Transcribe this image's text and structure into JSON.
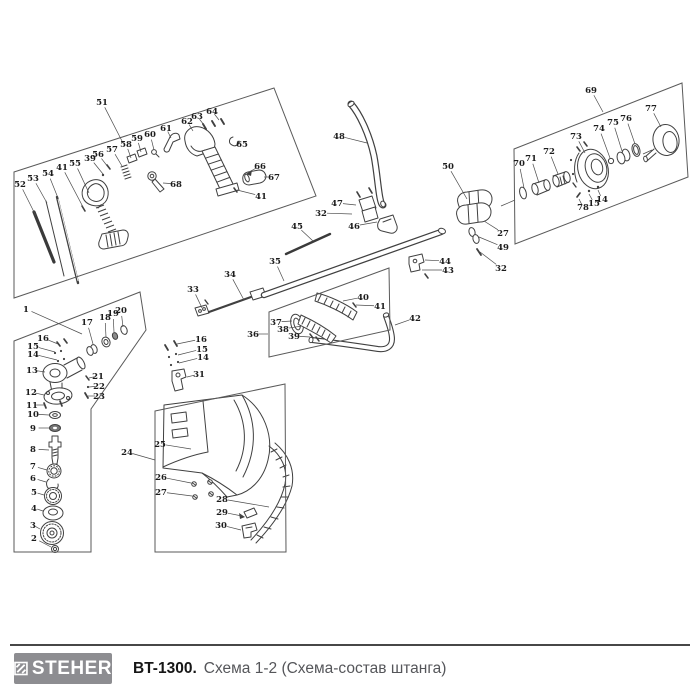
{
  "footer": {
    "brand": "STEHER",
    "model": "BT-1300.",
    "subtitle": "Схема 1-2 (Схема-состав штанга)",
    "logo_bg": "#8d8d91",
    "logo_text_color": "#ffffff",
    "model_color": "#161616",
    "subtitle_color": "#55565a",
    "rule_color": "#474747"
  },
  "diagram": {
    "stroke_color": "#404040",
    "label_color": "#1c1c1c",
    "leader_color": "#4c4c4c",
    "boxes": [
      {
        "name": "handle-trigger-assembly-box",
        "points": "14,172 274,88 316,196 14,298"
      },
      {
        "name": "starter-coupling-assembly-box",
        "points": "514,149 682,83 688,177 515,244"
      },
      {
        "name": "grip-assembly-box",
        "points": "269,312 389,268 390,330 269,357"
      },
      {
        "name": "guard-assembly-box",
        "points": "155,411 285,384 286,552 155,552"
      },
      {
        "name": "gearbox-assembly-box",
        "points": "14,341 140,292 146,330 91,409 91,552 14,552"
      }
    ],
    "labels": [
      {
        "n": "51",
        "x": 102,
        "y": 102,
        "tx": 123,
        "ty": 143
      },
      {
        "n": "52",
        "x": 20,
        "y": 184,
        "tx": 36,
        "ty": 216
      },
      {
        "n": "53",
        "x": 33,
        "y": 178,
        "tx": 47,
        "ty": 203
      },
      {
        "n": "54",
        "x": 48,
        "y": 173,
        "tx": 58,
        "ty": 198
      },
      {
        "n": "41",
        "x": 62,
        "y": 167,
        "tx": 83,
        "ty": 207
      },
      {
        "n": "55",
        "x": 75,
        "y": 163,
        "tx": 89,
        "ty": 193
      },
      {
        "n": "39",
        "x": 90,
        "y": 158,
        "tx": 103,
        "ty": 174
      },
      {
        "n": "56",
        "x": 98,
        "y": 154,
        "tx": 108,
        "ty": 167
      },
      {
        "n": "57",
        "x": 112,
        "y": 149,
        "tx": 122,
        "ty": 166
      },
      {
        "n": "58",
        "x": 126,
        "y": 144,
        "tx": 131,
        "ty": 158
      },
      {
        "n": "59",
        "x": 137,
        "y": 138,
        "tx": 141,
        "ty": 152
      },
      {
        "n": "60",
        "x": 150,
        "y": 134,
        "tx": 154,
        "ty": 150
      },
      {
        "n": "61",
        "x": 166,
        "y": 128,
        "tx": 171,
        "ty": 138
      },
      {
        "n": "62",
        "x": 187,
        "y": 121,
        "tx": 193,
        "ty": 131
      },
      {
        "n": "63",
        "x": 197,
        "y": 116,
        "tx": 204,
        "ty": 125
      },
      {
        "n": "64",
        "x": 212,
        "y": 111,
        "tx": 219,
        "ty": 120
      },
      {
        "n": "65",
        "x": 242,
        "y": 144,
        "tx": 237,
        "ty": 141
      },
      {
        "n": "66",
        "x": 260,
        "y": 166,
        "tx": 249,
        "ty": 172
      },
      {
        "n": "67",
        "x": 274,
        "y": 177,
        "tx": 264,
        "ty": 177
      },
      {
        "n": "41",
        "x": 261,
        "y": 196,
        "tx": 237,
        "ty": 190
      },
      {
        "n": "68",
        "x": 176,
        "y": 184,
        "tx": 163,
        "ty": 183
      },
      {
        "n": "48",
        "x": 339,
        "y": 136,
        "tx": 367,
        "ty": 143
      },
      {
        "n": "45",
        "x": 297,
        "y": 226,
        "tx": 313,
        "ty": 241
      },
      {
        "n": "47",
        "x": 337,
        "y": 203,
        "tx": 356,
        "ty": 205
      },
      {
        "n": "32",
        "x": 321,
        "y": 213,
        "tx": 352,
        "ty": 214
      },
      {
        "n": "46",
        "x": 354,
        "y": 226,
        "tx": 377,
        "ty": 222
      },
      {
        "n": "50",
        "x": 448,
        "y": 166,
        "tx": 467,
        "ty": 199
      },
      {
        "n": "27",
        "x": 503,
        "y": 233,
        "tx": 484,
        "ty": 221
      },
      {
        "n": "49",
        "x": 503,
        "y": 247,
        "tx": 479,
        "ty": 237
      },
      {
        "n": "32",
        "x": 501,
        "y": 268,
        "tx": 480,
        "ty": 252
      },
      {
        "n": "44",
        "x": 445,
        "y": 261,
        "tx": 425,
        "ty": 260
      },
      {
        "n": "43",
        "x": 448,
        "y": 270,
        "tx": 422,
        "ty": 270
      },
      {
        "n": "33",
        "x": 193,
        "y": 289,
        "tx": 202,
        "ty": 308
      },
      {
        "n": "34",
        "x": 230,
        "y": 274,
        "tx": 244,
        "ty": 300
      },
      {
        "n": "35",
        "x": 275,
        "y": 261,
        "tx": 284,
        "ty": 281
      },
      {
        "n": "36",
        "x": 253,
        "y": 334,
        "tx": 268,
        "ty": 334
      },
      {
        "n": "37",
        "x": 276,
        "y": 322,
        "tx": 292,
        "ty": 321
      },
      {
        "n": "38",
        "x": 283,
        "y": 329,
        "tx": 302,
        "ty": 326
      },
      {
        "n": "39",
        "x": 294,
        "y": 336,
        "tx": 310,
        "ty": 337
      },
      {
        "n": "40",
        "x": 363,
        "y": 297,
        "tx": 343,
        "ty": 301
      },
      {
        "n": "41",
        "x": 380,
        "y": 306,
        "tx": 356,
        "ty": 305
      },
      {
        "n": "42",
        "x": 415,
        "y": 318,
        "tx": 395,
        "ty": 325
      },
      {
        "n": "69",
        "x": 591,
        "y": 90,
        "tx": 603,
        "ty": 112
      },
      {
        "n": "70",
        "x": 519,
        "y": 163,
        "tx": 524,
        "ty": 188
      },
      {
        "n": "71",
        "x": 531,
        "y": 158,
        "tx": 539,
        "ty": 183
      },
      {
        "n": "72",
        "x": 549,
        "y": 151,
        "tx": 558,
        "ty": 174
      },
      {
        "n": "73",
        "x": 576,
        "y": 136,
        "tx": 585,
        "ty": 153
      },
      {
        "n": "74",
        "x": 599,
        "y": 128,
        "tx": 610,
        "ty": 158
      },
      {
        "n": "75",
        "x": 613,
        "y": 122,
        "tx": 622,
        "ty": 151
      },
      {
        "n": "76",
        "x": 626,
        "y": 118,
        "tx": 635,
        "ty": 144
      },
      {
        "n": "77",
        "x": 651,
        "y": 108,
        "tx": 661,
        "ty": 127
      },
      {
        "n": "78",
        "x": 583,
        "y": 207,
        "tx": 579,
        "ty": 199
      },
      {
        "n": "15",
        "x": 594,
        "y": 203,
        "tx": 589,
        "ty": 194
      },
      {
        "n": "14",
        "x": 602,
        "y": 199,
        "tx": 598,
        "ty": 190
      },
      {
        "n": "1",
        "x": 26,
        "y": 309,
        "tx": 82,
        "ty": 334
      },
      {
        "n": "16",
        "x": 43,
        "y": 338,
        "tx": 58,
        "ty": 344
      },
      {
        "n": "15",
        "x": 33,
        "y": 346,
        "tx": 55,
        "ty": 352
      },
      {
        "n": "14",
        "x": 33,
        "y": 354,
        "tx": 57,
        "ty": 360
      },
      {
        "n": "17",
        "x": 87,
        "y": 322,
        "tx": 93,
        "ty": 344
      },
      {
        "n": "18",
        "x": 105,
        "y": 317,
        "tx": 106,
        "ty": 337
      },
      {
        "n": "19",
        "x": 113,
        "y": 313,
        "tx": 114,
        "ty": 332
      },
      {
        "n": "20",
        "x": 121,
        "y": 310,
        "tx": 123,
        "ty": 327
      },
      {
        "n": "13",
        "x": 32,
        "y": 370,
        "tx": 45,
        "ty": 372
      },
      {
        "n": "21",
        "x": 98,
        "y": 376,
        "tx": 89,
        "ty": 378
      },
      {
        "n": "22",
        "x": 99,
        "y": 386,
        "tx": 89,
        "ty": 387
      },
      {
        "n": "23",
        "x": 99,
        "y": 396,
        "tx": 88,
        "ty": 396
      },
      {
        "n": "12",
        "x": 31,
        "y": 392,
        "tx": 44,
        "ty": 395
      },
      {
        "n": "11",
        "x": 32,
        "y": 405,
        "tx": 44,
        "ty": 405
      },
      {
        "n": "10",
        "x": 33,
        "y": 414,
        "tx": 49,
        "ty": 415
      },
      {
        "n": "9",
        "x": 33,
        "y": 428,
        "tx": 49,
        "ty": 428
      },
      {
        "n": "8",
        "x": 33,
        "y": 449,
        "tx": 49,
        "ty": 450
      },
      {
        "n": "7",
        "x": 33,
        "y": 466,
        "tx": 47,
        "ty": 470
      },
      {
        "n": "6",
        "x": 33,
        "y": 478,
        "tx": 46,
        "ty": 482
      },
      {
        "n": "5",
        "x": 34,
        "y": 492,
        "tx": 44,
        "ty": 495
      },
      {
        "n": "4",
        "x": 34,
        "y": 508,
        "tx": 43,
        "ty": 511
      },
      {
        "n": "3",
        "x": 33,
        "y": 525,
        "tx": 40,
        "ty": 529
      },
      {
        "n": "2",
        "x": 34,
        "y": 538,
        "tx": 51,
        "ty": 547
      },
      {
        "n": "16",
        "x": 201,
        "y": 339,
        "tx": 177,
        "ty": 344
      },
      {
        "n": "15",
        "x": 202,
        "y": 349,
        "tx": 178,
        "ty": 355
      },
      {
        "n": "14",
        "x": 203,
        "y": 357,
        "tx": 179,
        "ty": 363
      },
      {
        "n": "31",
        "x": 199,
        "y": 374,
        "tx": 187,
        "ty": 377
      },
      {
        "n": "24",
        "x": 127,
        "y": 452,
        "tx": 155,
        "ty": 460
      },
      {
        "n": "25",
        "x": 160,
        "y": 444,
        "tx": 191,
        "ty": 449
      },
      {
        "n": "26",
        "x": 161,
        "y": 477,
        "tx": 191,
        "ty": 483
      },
      {
        "n": "27",
        "x": 161,
        "y": 492,
        "tx": 192,
        "ty": 496
      },
      {
        "n": "28",
        "x": 222,
        "y": 499,
        "tx": 269,
        "ty": 507
      },
      {
        "n": "29",
        "x": 222,
        "y": 512,
        "tx": 242,
        "ty": 516
      },
      {
        "n": "30",
        "x": 221,
        "y": 525,
        "tx": 241,
        "ty": 530
      }
    ]
  }
}
